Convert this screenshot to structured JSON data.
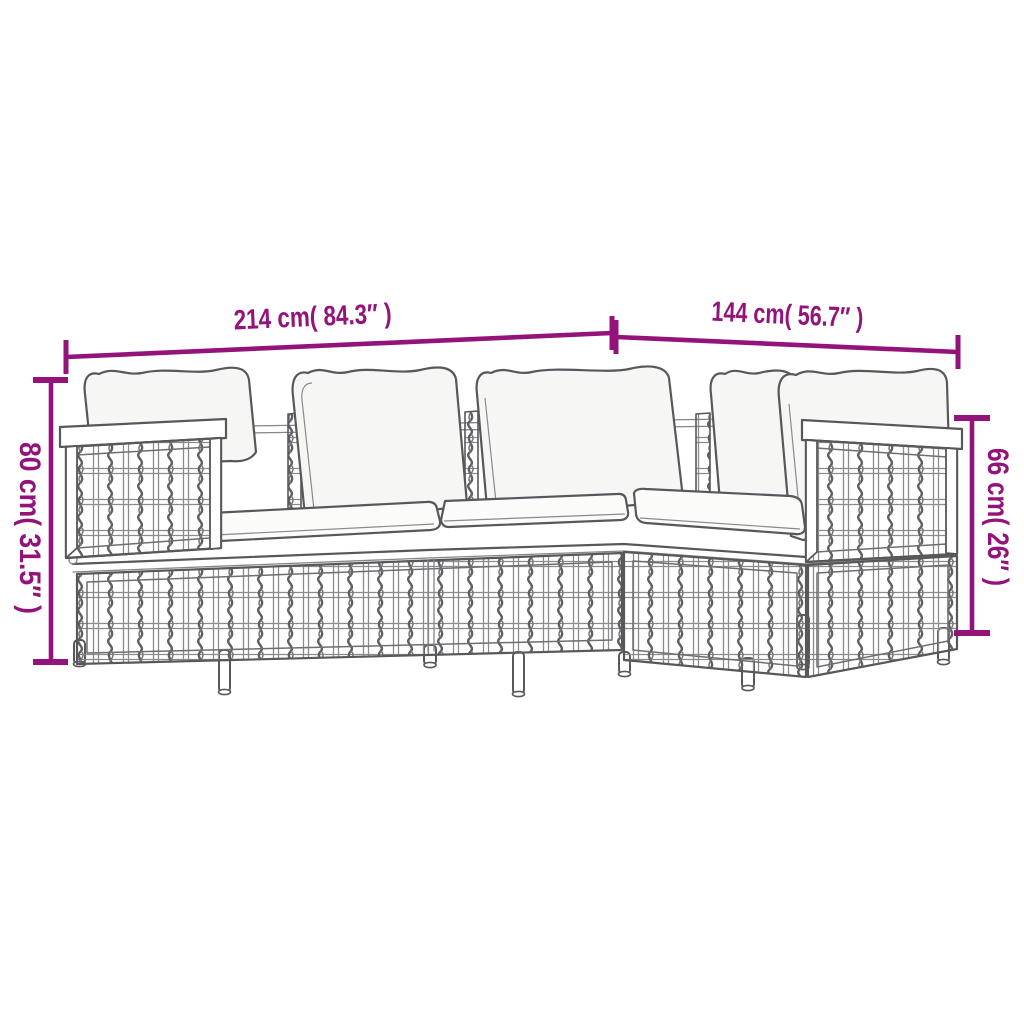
{
  "diagram": {
    "type": "product-dimension-line-drawing",
    "subject": "modular poly rattan garden lounge sofa set with cushions",
    "dimensions": {
      "back_width": "214 cm( 84.3″ )",
      "side_width": "144 cm( 56.7″ )",
      "left_height": "80 cm( 31.5″ )",
      "right_height": "66 cm( 26″ )"
    },
    "colors": {
      "dimension_accent": "#93137B",
      "furniture_line": "#58585B",
      "cushion_fill": "#F6F6F4",
      "background": "#FFFFFF"
    }
  }
}
